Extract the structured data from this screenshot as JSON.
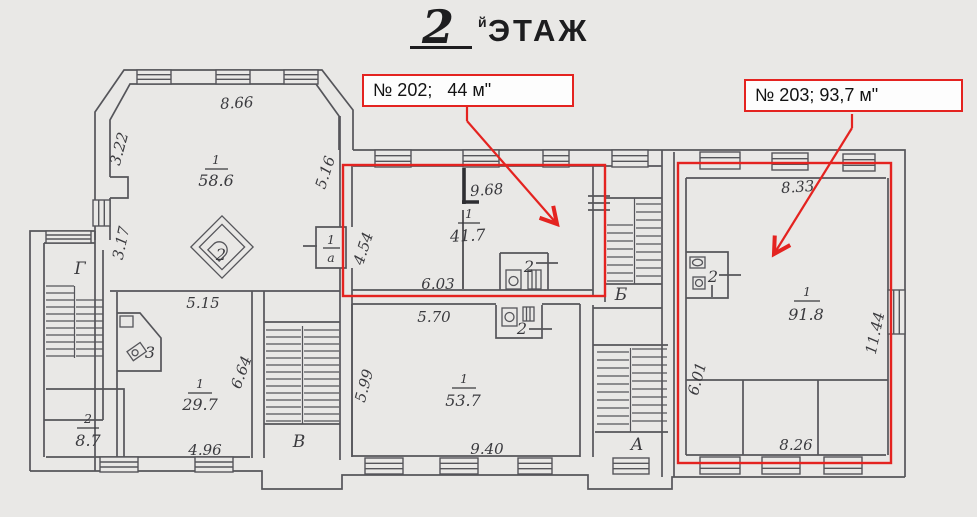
{
  "title": {
    "number": "2",
    "suffix": "й",
    "word": "ЭТАЖ"
  },
  "callouts": {
    "c202": "№ 202;   44 м\"",
    "c203": "№ 203; 93,7 м\""
  },
  "accent_red": "#e42320",
  "rooms": {
    "r58": {
      "num": "1",
      "area": "58.6"
    },
    "r29": {
      "num": "1",
      "area": "29.7"
    },
    "r8": {
      "num": "2",
      "area": "8.7"
    },
    "r41": {
      "num": "1",
      "area": "41.7"
    },
    "r53": {
      "num": "1",
      "area": "53.7"
    },
    "r91": {
      "num": "1",
      "area": "91.8"
    },
    "ra": {
      "num": "1",
      "area": "а"
    }
  },
  "small": {
    "stove": "2",
    "wc3": "3",
    "alc202": "2",
    "alc537": "2",
    "wc203": "2"
  },
  "stairs": {
    "g": "Г",
    "v": "В",
    "b": "Б",
    "a": "А"
  },
  "dims": {
    "d866": "8.66",
    "d322": "3.22",
    "d317": "3.17",
    "d516": "5.16",
    "d968": "9.68",
    "d454": "4.54",
    "d603": "6.03",
    "d515": "5.15",
    "d664": "6.64",
    "d496": "4.96",
    "d570": "5.70",
    "d599": "5.99",
    "d940": "9.40",
    "d833": "8.33",
    "d1144": "11.44",
    "d601": "6.01",
    "d826": "8.26"
  }
}
